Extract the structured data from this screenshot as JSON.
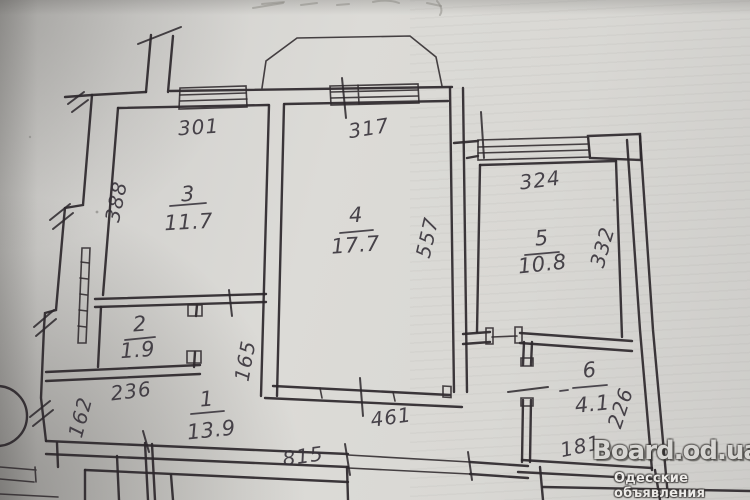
{
  "plan": {
    "rooms": {
      "room1": {
        "number": "1",
        "area": "13.9"
      },
      "room2": {
        "number": "2",
        "area": "1.9"
      },
      "room3": {
        "number": "3",
        "area": "11.7"
      },
      "room4": {
        "number": "4",
        "area": "17.7"
      },
      "room5": {
        "number": "5",
        "area": "10.8"
      },
      "room6": {
        "number": "6",
        "area": "4.1"
      }
    },
    "dimensions": {
      "top_room3": "301",
      "top_room4": "317",
      "top_room5": "324",
      "left_room3": "388",
      "right_room4": "557",
      "right_room5": "332",
      "hall_width": "236",
      "hall_left": "162",
      "hall_inner": "165",
      "bottom_total": "815",
      "bottom_room4": "461",
      "room6_bottom": "181",
      "room6_right": "226"
    },
    "watermark": {
      "title": "Board.od.ua",
      "subtitle": "Одесские объявления"
    }
  }
}
